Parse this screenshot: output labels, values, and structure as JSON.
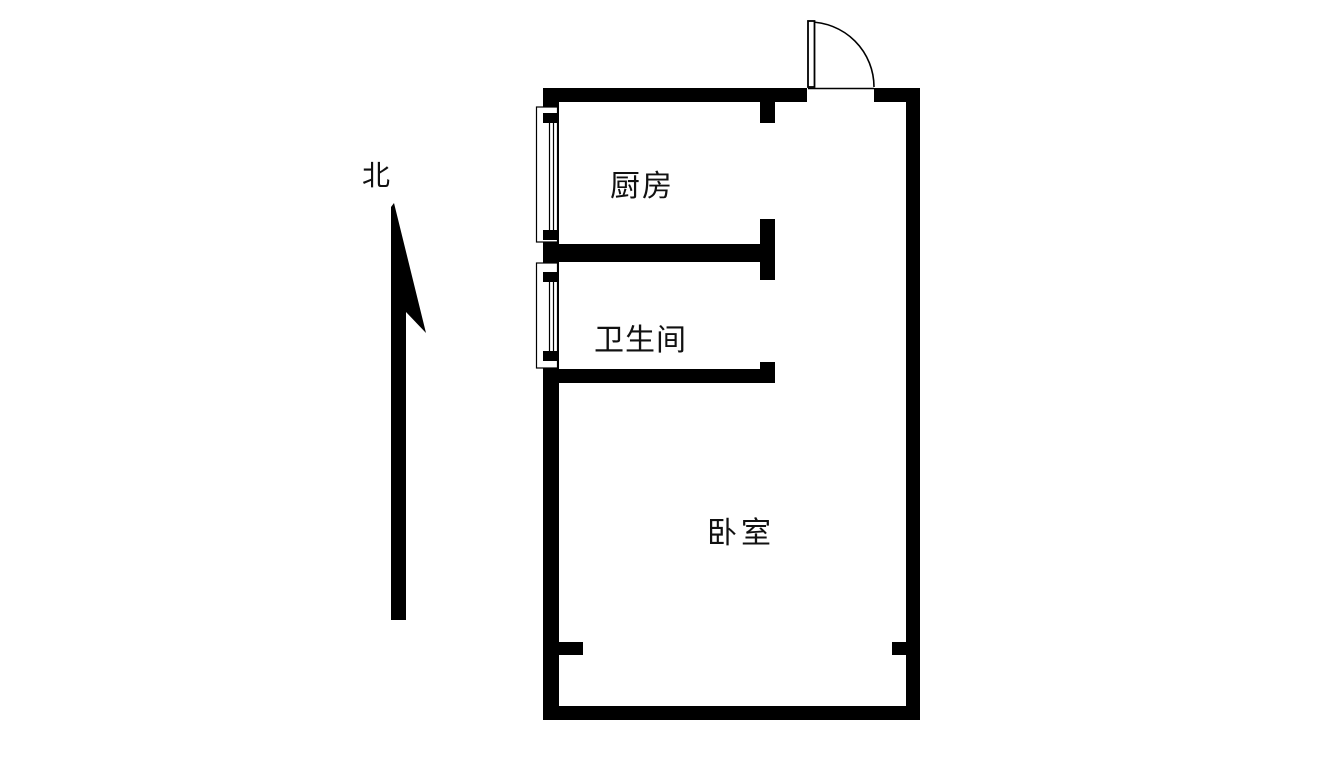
{
  "page": {
    "width": 1325,
    "height": 775,
    "type_label": "floor-plan"
  },
  "colors": {
    "wall": "#000000",
    "text": "#111111",
    "background": "#ffffff"
  },
  "plan": {
    "compass": {
      "label": "北",
      "direction": "up"
    },
    "rooms": {
      "kitchen": {
        "label": "厨房"
      },
      "bathroom": {
        "label": "卫生间"
      },
      "bedroom": {
        "label": "卧室"
      }
    },
    "features": {
      "window_count": 2,
      "door_count": 1
    }
  }
}
